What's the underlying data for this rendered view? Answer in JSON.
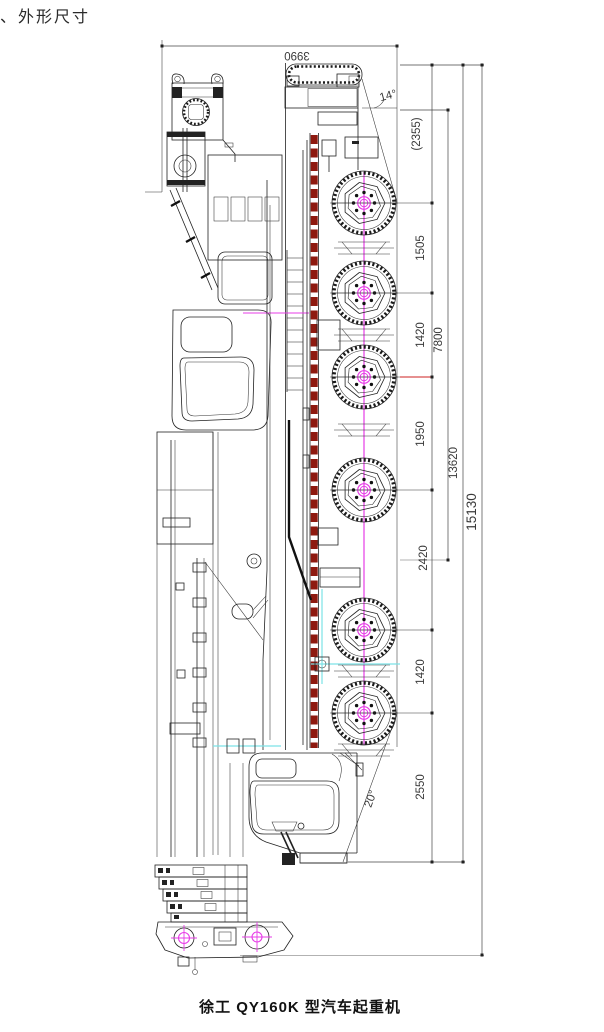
{
  "page": {
    "heading": "、外形尺寸",
    "caption": "徐工 QY160K 型汽车起重机"
  },
  "drawing_labels": {
    "overall_height": "3990",
    "angle_rear": "14°",
    "angle_front": "20°",
    "ref_rear_to_axle1": "(2355)",
    "axle_1_2": "1505",
    "axle_2_3": "1420",
    "bogie_span": "7800",
    "axle_3_4": "1950",
    "axle_4_5": "2420",
    "axle_5_6": "1420",
    "front_overhang": "2550",
    "frame_length": "13620",
    "overall_length": "15130"
  },
  "legend_colors": {
    "centerline_magenta": "#e73ce7",
    "boom_stripe_red": "#8e1a10",
    "outrigger_cyan": "#7ce2e6",
    "line_black": "#222222",
    "highlight_red": "#cc2222"
  }
}
